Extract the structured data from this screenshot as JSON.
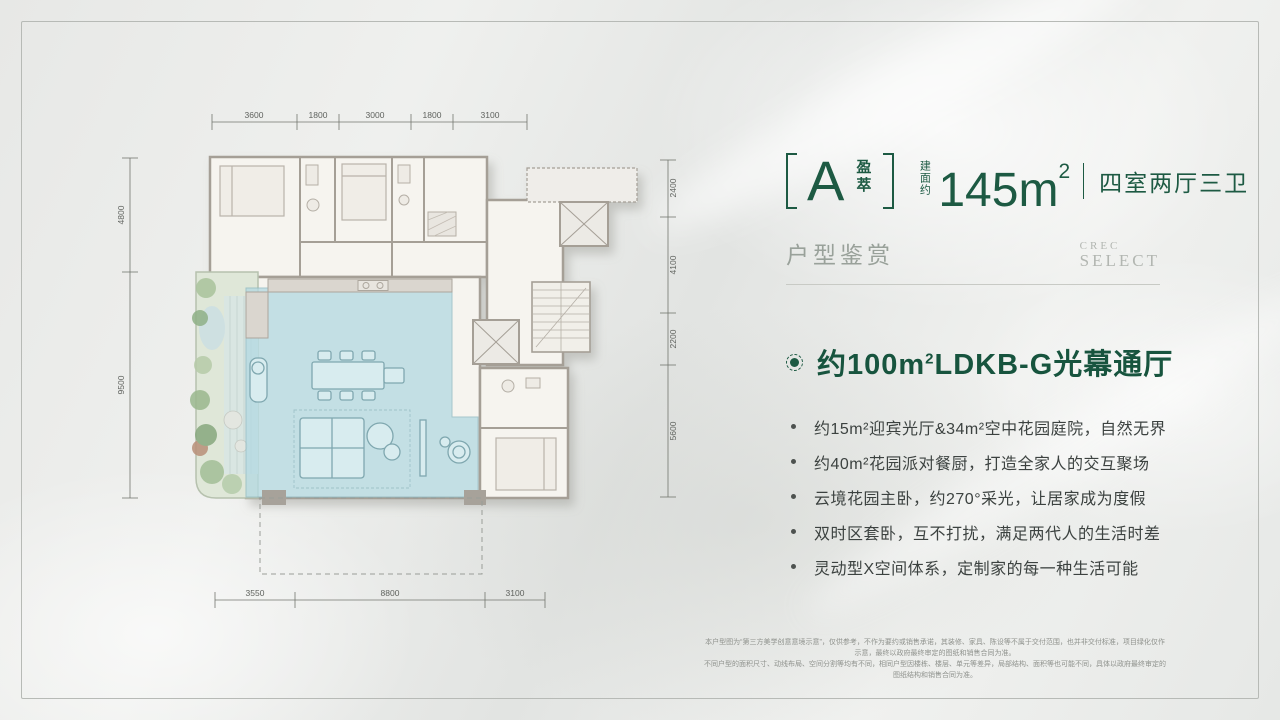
{
  "page": {
    "accent_green": "#1d5a43",
    "bg": "#e9eae8",
    "highlight_blue": "#b5dae2",
    "garden_green": "#dfe7d8"
  },
  "header": {
    "type_letter": "A",
    "type_name": "盈萃",
    "area_label": "建面约",
    "area_value": "145m",
    "area_sup": "2",
    "layout_text": "四室两厅三卫",
    "section_title": "户型鉴赏",
    "brand_line1": "CREC",
    "brand_line2": "SELECT"
  },
  "content": {
    "headline": {
      "pre": "约100m",
      "sup": "2",
      "post": "LDKB-G光幕通厅"
    },
    "bullets": [
      "约15m²迎宾光厅&34m²空中花园庭院，自然无界",
      "约40m²花园派对餐厨，打造全家人的交互聚场",
      "云境花园主卧，约270°采光，让居家成为度假",
      "双时区套卧，互不打扰，满足两代人的生活时差",
      "灵动型X空间体系，定制家的每一种生活可能"
    ]
  },
  "plan": {
    "dims_top": [
      "3600",
      "1800",
      "3000",
      "1800",
      "3100"
    ],
    "dims_left": [
      "4800",
      "9500"
    ],
    "dims_right": [
      "2400",
      "4100",
      "2200",
      "5600"
    ],
    "dims_bottom": [
      "3550",
      "8800",
      "3100"
    ]
  },
  "footer": {
    "line1": "本户型图为“第三方美学创意意境示意”，仅供参考，不作为要约或销售承诺，其装修、家具、陈设等不属于交付范围，也并非交付标准，项目绿化仅作示意，最终以政府最终审定的图纸和销售合同为准。",
    "line2": "不同户型的面积尺寸、动线布局、空间分割等均有不同，相同户型因楼栋、楼层、单元等差异，局部结构、面积等也可能不同，具体以政府最终审定的图纸结构和销售合同为准。"
  }
}
